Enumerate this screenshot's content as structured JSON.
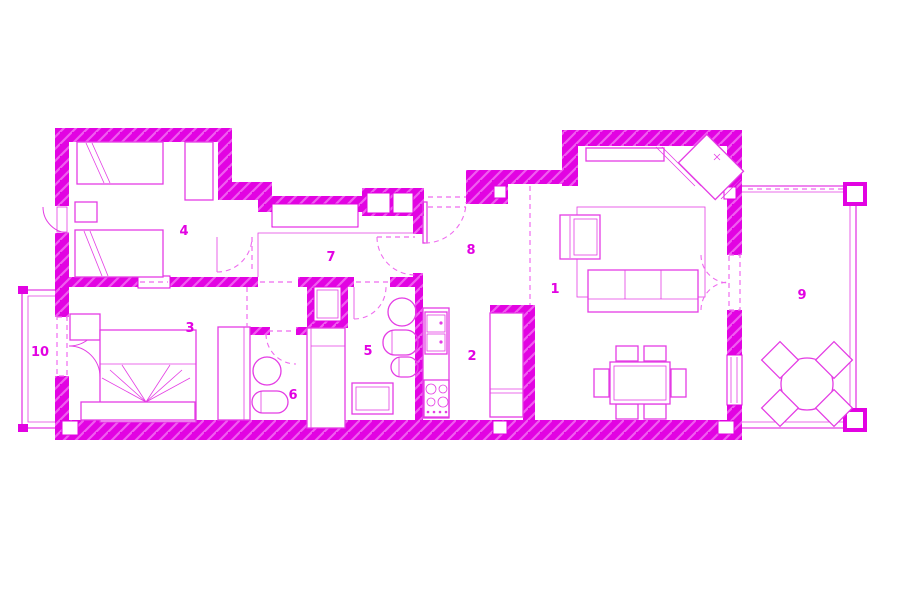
{
  "plan": {
    "colors": {
      "wall": "#e203e2",
      "furniture": "#e43ce4",
      "door": "#ef6bef",
      "background": "#ffffff"
    },
    "rooms": [
      {
        "label": "1",
        "name": "living-dining-room"
      },
      {
        "label": "2",
        "name": "kitchen"
      },
      {
        "label": "3",
        "name": "bedroom-main"
      },
      {
        "label": "4",
        "name": "bedroom-twin"
      },
      {
        "label": "5",
        "name": "bathroom-main"
      },
      {
        "label": "6",
        "name": "bathroom-ensuite"
      },
      {
        "label": "7",
        "name": "hallway"
      },
      {
        "label": "8",
        "name": "entrance-hall"
      },
      {
        "label": "9",
        "name": "terrace"
      },
      {
        "label": "10",
        "name": "balcony"
      }
    ]
  }
}
